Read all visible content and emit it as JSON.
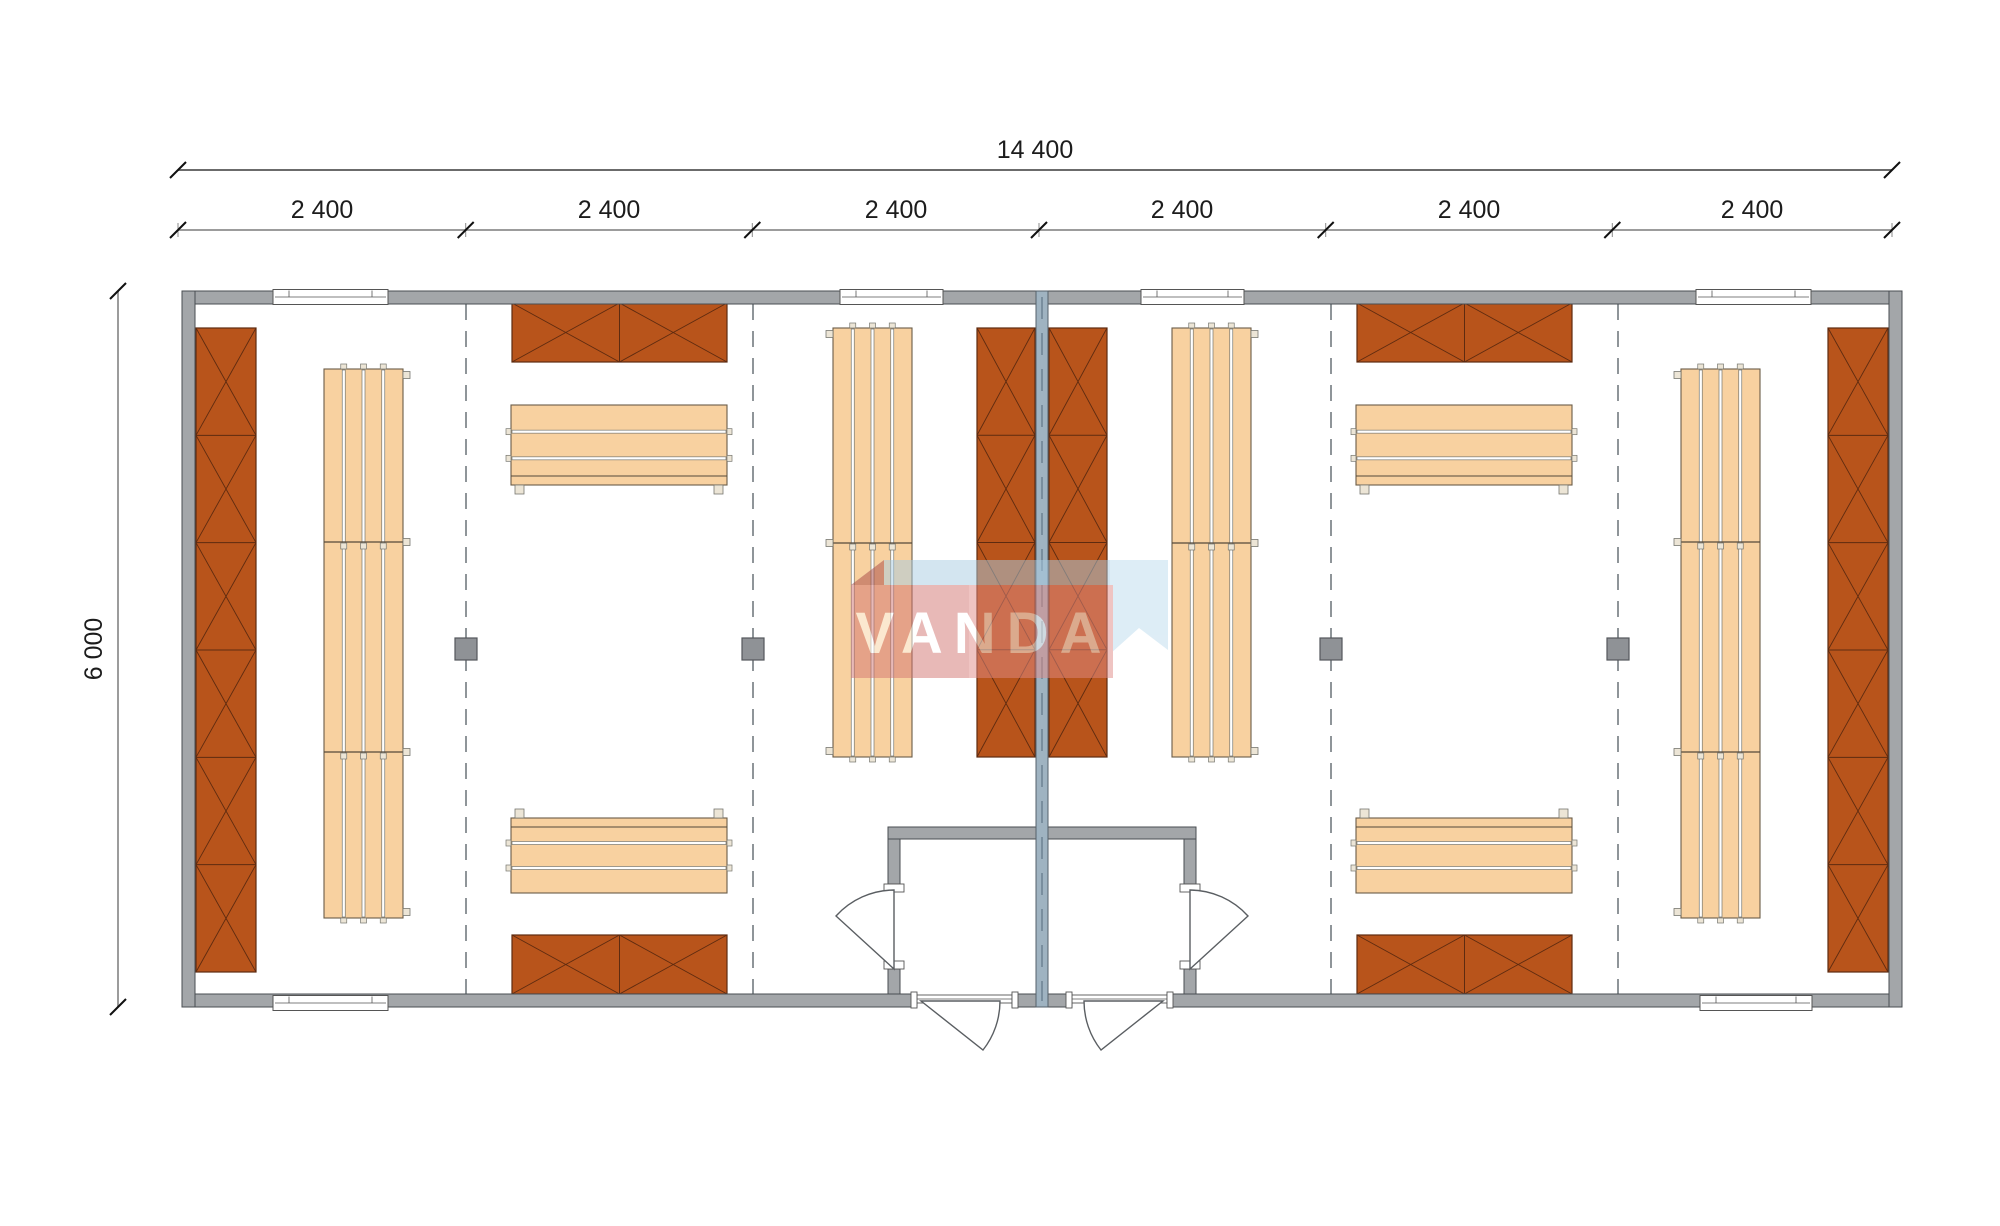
{
  "drawing_title": "modular sauna / cabin floor plan",
  "dimensions": {
    "total": "14 400",
    "height": "6 000",
    "modules": [
      "2 400",
      "2 400",
      "2 400",
      "2 400",
      "2 400",
      "2 400"
    ]
  },
  "watermark": {
    "text": "VANDA"
  },
  "colors": {
    "bg": "#ffffff",
    "wall": "#a3a6a9",
    "wall_stroke": "#4a4e52",
    "center_wall": "#9fb3c1",
    "center_wall_stroke": "#56616b",
    "center_axis": "#6d8193",
    "panel": "#b8541b",
    "panel_stroke": "#5e2b10",
    "bench": "#f8d1a0",
    "bench_stroke": "#6a5c48",
    "gap_stroke": "#777770",
    "tab_fill": "#ece5d6",
    "post": "#8f9296",
    "post_stroke": "#54585c",
    "divider": "#8f9599",
    "dim_text": "#1c1c1c",
    "dim_line1": "#6b6b6b",
    "dim_line2": "#9c9c9c",
    "tick": "#111111",
    "door_stroke": "#5a5e62",
    "frame_stroke": "#555555",
    "wm_red": "#e18b86",
    "wm_red_dark": "#c96560",
    "wm_fold": "#a84744",
    "wm_blue": "#bddcee",
    "wm_blue_dark": "#a8cce2",
    "wm_text": "#ffffff"
  },
  "plan": {
    "canvas": {
      "w": 2000,
      "h": 1226
    },
    "outline": {
      "x": 182,
      "y": 291,
      "w": 1720,
      "h": 716,
      "t": 13
    },
    "bottom_wall_segments": [
      [
        182,
        917
      ],
      [
        1012,
        1072
      ],
      [
        1167,
        1902
      ]
    ],
    "center_wall": {
      "x": 1036,
      "y": 291,
      "w": 12,
      "h": 716
    },
    "vestibule_top": [
      888,
      827,
      308,
      12
    ],
    "vestibule_walls": [
      [
        888,
        839,
        12,
        45
      ],
      [
        1184,
        839,
        12,
        45
      ],
      [
        888,
        969,
        12,
        25
      ],
      [
        1184,
        969,
        12,
        25
      ]
    ],
    "door_frames": [
      [
        884,
        884,
        20,
        8
      ],
      [
        884,
        961,
        20,
        8
      ],
      [
        1180,
        884,
        20,
        8
      ],
      [
        1180,
        961,
        20,
        8
      ]
    ],
    "jambs": [
      [
        911,
        992,
        6,
        16
      ],
      [
        1012,
        992,
        6,
        16
      ],
      [
        1066,
        992,
        6,
        16
      ],
      [
        1167,
        992,
        6,
        16
      ]
    ],
    "sills": [
      [
        917,
        995,
        95,
        8
      ],
      [
        1072,
        995,
        95,
        8
      ]
    ],
    "doors": [
      "M894,969 L836,916 A79,79 0 0 1 894,890 Z",
      "M1190,969 L1248,916 A79,79 0 0 0 1190,890 Z",
      "M921,1001 L983,1050 A79,79 0 0 0 1000,1001 Z",
      "M1163,1001 L1101,1050 A79,79 0 0 1 1084,1001 Z"
    ],
    "windows_top": [
      [
        273,
        115
      ],
      [
        840,
        103
      ],
      [
        1141,
        103
      ],
      [
        1696,
        115
      ]
    ],
    "windows_bottom": [
      [
        273,
        115
      ],
      [
        1700,
        112
      ]
    ],
    "x_panels": [
      {
        "x": 196,
        "y": 328,
        "w": 60,
        "h": 644,
        "cells": 6,
        "dir": "v"
      },
      {
        "x": 1828,
        "y": 328,
        "w": 60,
        "h": 644,
        "cells": 6,
        "dir": "v"
      },
      {
        "x": 977,
        "y": 328,
        "w": 58,
        "h": 429,
        "cells": 4,
        "dir": "v"
      },
      {
        "x": 1049,
        "y": 328,
        "w": 58,
        "h": 429,
        "cells": 4,
        "dir": "v"
      },
      {
        "x": 512,
        "y": 303,
        "w": 215,
        "h": 59,
        "cells": 2,
        "dir": "h"
      },
      {
        "x": 512,
        "y": 935,
        "w": 215,
        "h": 59,
        "cells": 2,
        "dir": "h"
      },
      {
        "x": 1357,
        "y": 303,
        "w": 215,
        "h": 59,
        "cells": 2,
        "dir": "h"
      },
      {
        "x": 1357,
        "y": 935,
        "w": 215,
        "h": 59,
        "cells": 2,
        "dir": "h"
      }
    ],
    "benches_v": [
      {
        "x": 324,
        "y": 369,
        "w": 79,
        "h": 549,
        "sections": [
          542,
          752
        ],
        "tab": "r"
      },
      {
        "x": 833,
        "y": 328,
        "w": 79,
        "h": 429,
        "sections": [
          543
        ],
        "tab": "l"
      },
      {
        "x": 1172,
        "y": 328,
        "w": 79,
        "h": 429,
        "sections": [
          543
        ],
        "tab": "r"
      },
      {
        "x": 1681,
        "y": 369,
        "w": 79,
        "h": 549,
        "sections": [
          542,
          752
        ],
        "tab": "l"
      }
    ],
    "benches_h": [
      {
        "x": 511,
        "y": 405,
        "w": 216,
        "h": 80,
        "feet": "b"
      },
      {
        "x": 511,
        "y": 818,
        "w": 216,
        "h": 75,
        "feet": "t"
      },
      {
        "x": 1356,
        "y": 405,
        "w": 216,
        "h": 80,
        "feet": "b"
      },
      {
        "x": 1356,
        "y": 818,
        "w": 216,
        "h": 75,
        "feet": "t"
      }
    ],
    "posts": [
      [
        466,
        649
      ],
      [
        753,
        649
      ],
      [
        1331,
        649
      ],
      [
        1618,
        649
      ]
    ],
    "dividers": [
      466,
      753,
      1331,
      1618
    ],
    "dims": {
      "line1": {
        "y": 170,
        "x0": 178,
        "x1": 1892,
        "label_x": 1035,
        "label_y": 158
      },
      "line2": {
        "y": 230,
        "ticks": [
          178,
          465.7,
          752.3,
          1039,
          1325.7,
          1612.3,
          1892
        ],
        "label_y": 218,
        "label_centers": [
          322,
          609,
          896,
          1182,
          1469,
          1752
        ]
      },
      "vline": {
        "x": 118,
        "y0": 291,
        "y1": 1007,
        "label_x": 102,
        "label_y": 649
      }
    },
    "watermark_geo": {
      "blue_top": "851,585 884,560 1168,560 1135,585",
      "blue_right": "1110,560 1168,560 1168,650 1139,628 1110,654",
      "fold": "851,585 884,560 884,585",
      "band": [
        851,
        585,
        262,
        93
      ],
      "band_dark": [
        851,
        585,
        118,
        93
      ],
      "text_x": 984,
      "text_y": 653,
      "opacity": 0.5
    }
  }
}
